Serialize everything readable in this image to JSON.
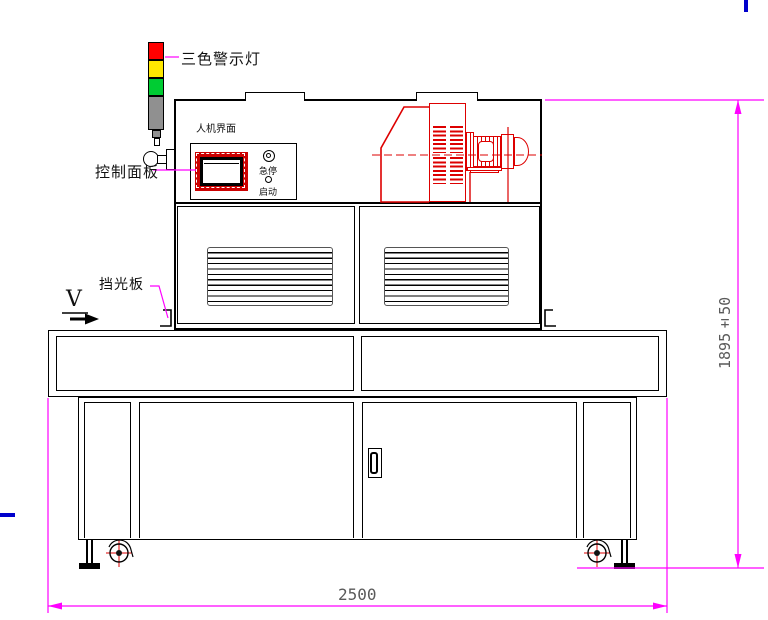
{
  "drawing": {
    "type": "engineering-front-view",
    "labels": {
      "warning_light": "三色警示灯",
      "hmi": "人机界面",
      "control_panel": "控制面板",
      "emergency_stop": "急停",
      "start": "启动",
      "light_shield": "挡光板",
      "direction": "V"
    },
    "dimensions": {
      "overall_width": "2500",
      "overall_height": "1895±50"
    },
    "icons": {
      "beacon": "three-color-stack-light",
      "estop_button": "double-circle",
      "start_button": "circle",
      "casters": "swivel-wheel-with-crosshair",
      "feet": "leveling-foot"
    },
    "colors": {
      "outline": "#000000",
      "component_red": "#dd0000",
      "dimension_magenta": "#ff00ff",
      "dimension_text": "#5a5a5a",
      "beacon_red": "#ff0000",
      "beacon_yellow": "#ffe800",
      "beacon_green": "#00cc33",
      "pole_gray": "#909090",
      "accent_blue": "#0000cc"
    }
  }
}
